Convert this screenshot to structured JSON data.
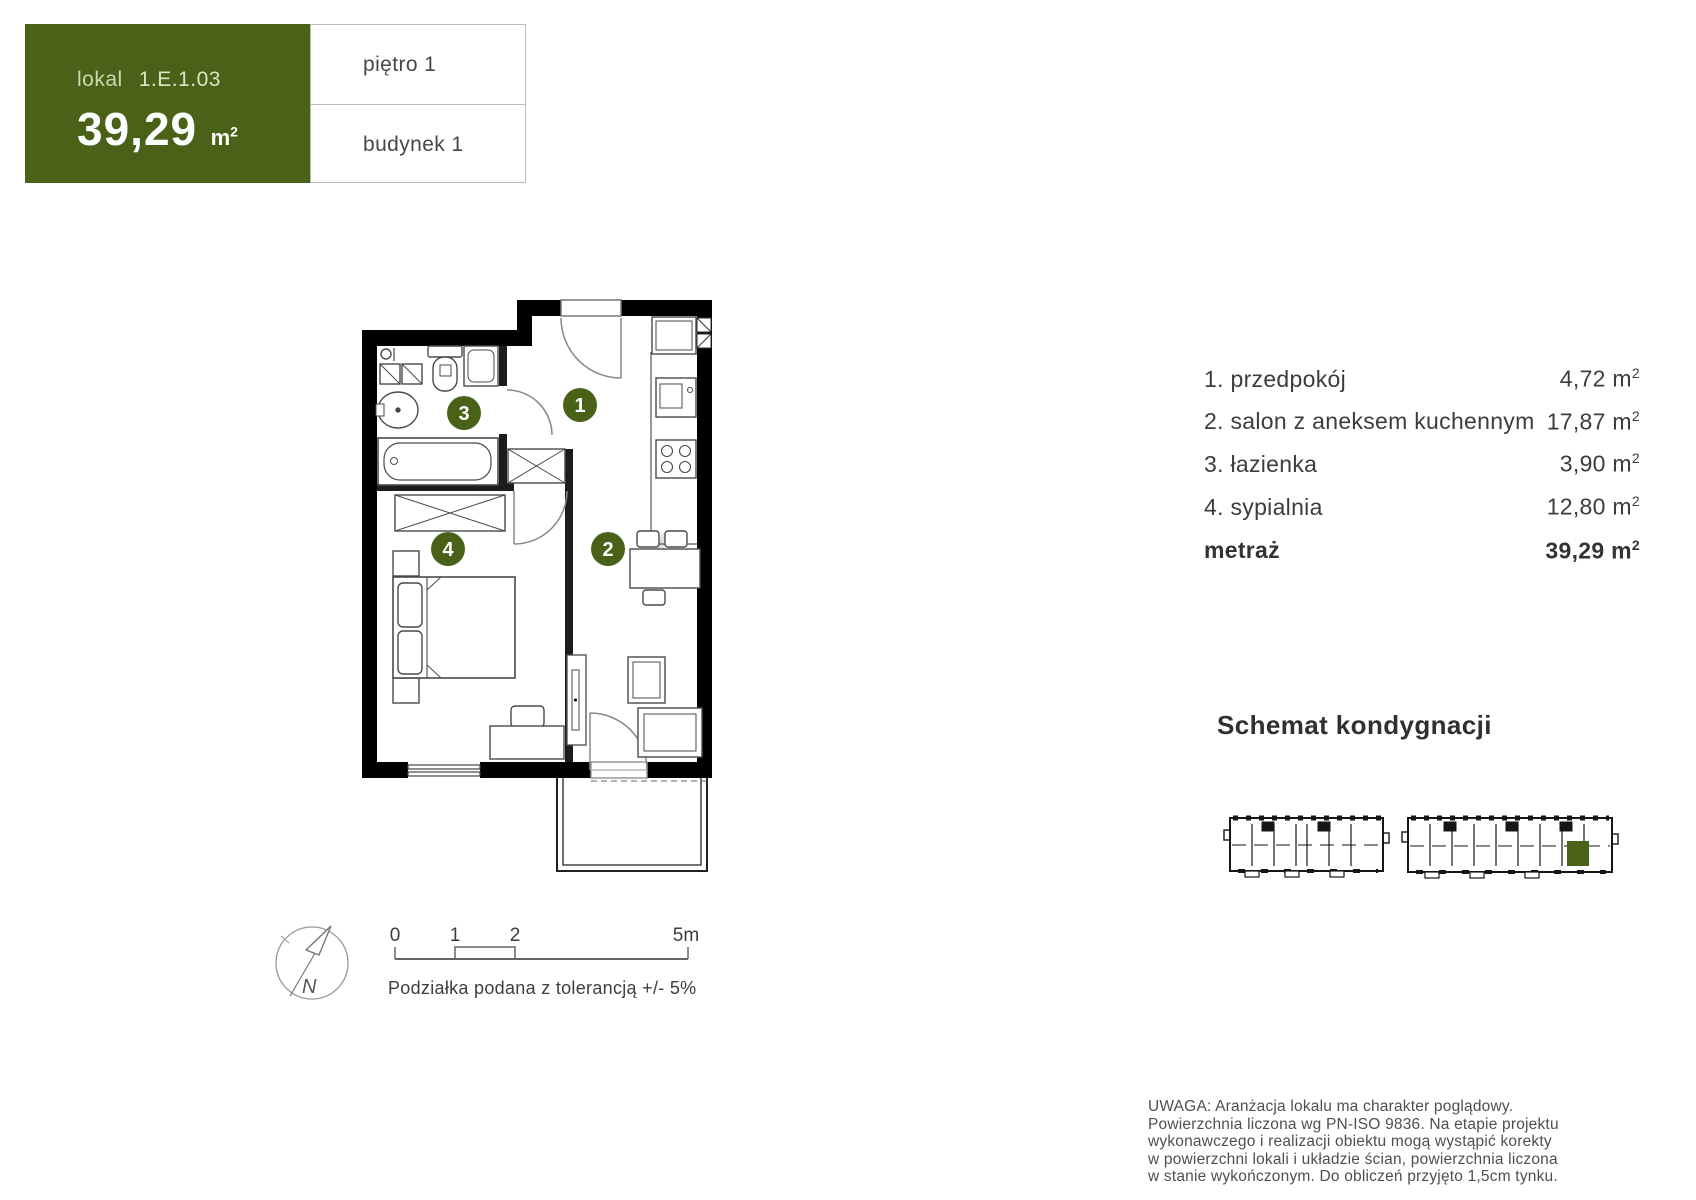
{
  "colors": {
    "accent_green": "#4a6118",
    "wall_black": "#000000",
    "text_dark": "#3c3c3c",
    "border_gray": "#b9b9b9",
    "watermark_gray": "#e2e2e2"
  },
  "header": {
    "unit_label": "lokal",
    "unit_id": "1.E.1.03",
    "area_value": "39,29",
    "area_unit": "m",
    "area_sup": "2",
    "floor_label": "piętro 1",
    "building_label": "budynek 1"
  },
  "plan": {
    "markers": [
      "1",
      "2",
      "3",
      "4"
    ]
  },
  "room_list": {
    "items": [
      {
        "label": "1. przedpokój",
        "area": "4,72 m",
        "sup": "2"
      },
      {
        "label": "2. salon z aneksem kuchennym",
        "area": "17,87 m",
        "sup": "2"
      },
      {
        "label": "3. łazienka",
        "area": "3,90 m",
        "sup": "2"
      },
      {
        "label": "4. sypialnia",
        "area": "12,80 m",
        "sup": "2"
      }
    ],
    "total_label": "metraż",
    "total_area": "39,29 m",
    "total_sup": "2"
  },
  "scale_bar": {
    "tick_0": "0",
    "tick_1": "1",
    "tick_2": "2",
    "tick_end": "5m",
    "caption": "Podziałka podana z tolerancją +/- 5%",
    "north_label": "N"
  },
  "floor_schematic": {
    "title": "Schemat kondygnacji"
  },
  "watermark_letter": "A",
  "disclaimer": "UWAGA: Aranżacja lokalu ma charakter poglądowy. Powierzchnia liczona wg PN-ISO 9836. Na etapie projektu wykonawczego i realizacji obiektu mogą wystąpić korekty w powierzchni lokali i układzie ścian, powierzchnia liczona w stanie wykończonym. Do obliczeń przyjęto 1,5cm tynku."
}
